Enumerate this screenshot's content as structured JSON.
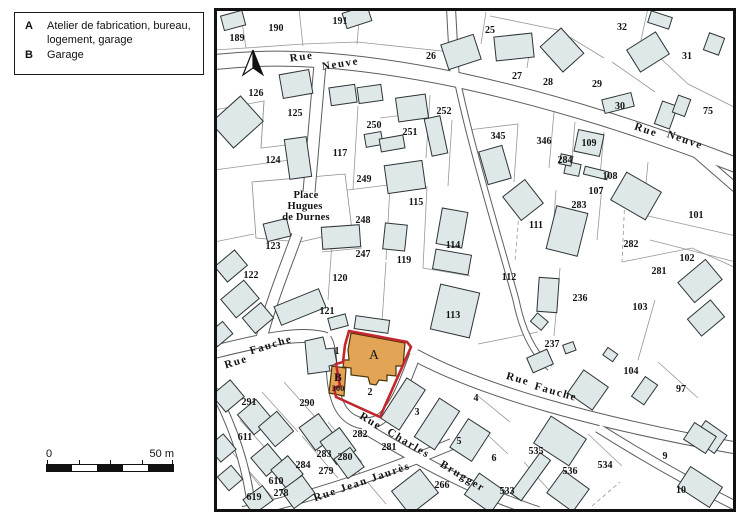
{
  "legend": {
    "items": [
      {
        "key": "A",
        "label": "Atelier de fabrication, bureau,\nlogement, garage"
      },
      {
        "key": "B",
        "label": "Garage"
      }
    ]
  },
  "scale_bar": {
    "start": "0",
    "end": "50 m"
  },
  "map": {
    "colors": {
      "building_fill": "#dfe8e9",
      "highlight_outline": "#c1272d",
      "highlight_building": "#e2a455"
    },
    "highlight": {
      "building_a_label": "A",
      "building_b_label": "B",
      "house_number": "300",
      "parcel_2_label": "2"
    },
    "street_labels": [
      {
        "text": "Rue",
        "x": 302,
        "y": 60,
        "rot": -8,
        "cls": "street"
      },
      {
        "text": "Neuve",
        "x": 341,
        "y": 67,
        "rot": -9,
        "cls": "street"
      },
      {
        "text": "Rue",
        "x": 645,
        "y": 133,
        "rot": 19,
        "cls": "street"
      },
      {
        "text": "Neuve",
        "x": 684,
        "y": 143,
        "rot": 19,
        "cls": "street"
      },
      {
        "text": "Place",
        "x": 306,
        "y": 198,
        "rot": 0,
        "cls": "place"
      },
      {
        "text": "Hugues",
        "x": 305,
        "y": 209,
        "rot": 0,
        "cls": "place"
      },
      {
        "text": "de Durnes",
        "x": 306,
        "y": 220,
        "rot": 0,
        "cls": "place"
      },
      {
        "text": "Rue",
        "x": 237,
        "y": 365,
        "rot": -17,
        "cls": "street"
      },
      {
        "text": "Fauche",
        "x": 272,
        "y": 348,
        "rot": -17,
        "cls": "street"
      },
      {
        "text": "Rue",
        "x": 517,
        "y": 382,
        "rot": 16,
        "cls": "street"
      },
      {
        "text": "Fauche",
        "x": 555,
        "y": 395,
        "rot": 16,
        "cls": "street"
      },
      {
        "text": "Rue",
        "x": 369,
        "y": 424,
        "rot": 31,
        "cls": "street"
      },
      {
        "text": "Charles",
        "x": 407,
        "y": 446,
        "rot": 31,
        "cls": "street"
      },
      {
        "text": "Brugger",
        "x": 461,
        "y": 479,
        "rot": 31,
        "cls": "street"
      },
      {
        "text": "Rue Jean Jaurès",
        "x": 363,
        "y": 485,
        "rot": -19,
        "cls": "street"
      }
    ],
    "parcel_labels": [
      {
        "text": "189",
        "x": 237,
        "y": 41
      },
      {
        "text": "190",
        "x": 276,
        "y": 31
      },
      {
        "text": "191",
        "x": 340,
        "y": 24
      },
      {
        "text": "25",
        "x": 490,
        "y": 33
      },
      {
        "text": "26",
        "x": 431,
        "y": 59
      },
      {
        "text": "27",
        "x": 517,
        "y": 79
      },
      {
        "text": "28",
        "x": 548,
        "y": 85
      },
      {
        "text": "29",
        "x": 597,
        "y": 87
      },
      {
        "text": "30",
        "x": 620,
        "y": 109
      },
      {
        "text": "31",
        "x": 687,
        "y": 59
      },
      {
        "text": "32",
        "x": 622,
        "y": 30
      },
      {
        "text": "75",
        "x": 708,
        "y": 114
      },
      {
        "text": "126",
        "x": 256,
        "y": 96
      },
      {
        "text": "125",
        "x": 295,
        "y": 116
      },
      {
        "text": "124",
        "x": 273,
        "y": 163
      },
      {
        "text": "117",
        "x": 340,
        "y": 156
      },
      {
        "text": "250",
        "x": 374,
        "y": 128
      },
      {
        "text": "251",
        "x": 410,
        "y": 135
      },
      {
        "text": "252",
        "x": 444,
        "y": 114
      },
      {
        "text": "345",
        "x": 498,
        "y": 139
      },
      {
        "text": "346",
        "x": 544,
        "y": 144
      },
      {
        "text": "109",
        "x": 589,
        "y": 146
      },
      {
        "text": "284",
        "x": 565,
        "y": 163
      },
      {
        "text": "108",
        "x": 610,
        "y": 179
      },
      {
        "text": "107",
        "x": 596,
        "y": 194
      },
      {
        "text": "283",
        "x": 579,
        "y": 208
      },
      {
        "text": "101",
        "x": 696,
        "y": 218
      },
      {
        "text": "102",
        "x": 687,
        "y": 261
      },
      {
        "text": "282",
        "x": 631,
        "y": 247
      },
      {
        "text": "281",
        "x": 659,
        "y": 274
      },
      {
        "text": "103",
        "x": 640,
        "y": 310
      },
      {
        "text": "249",
        "x": 364,
        "y": 182
      },
      {
        "text": "115",
        "x": 416,
        "y": 205
      },
      {
        "text": "248",
        "x": 363,
        "y": 223
      },
      {
        "text": "247",
        "x": 363,
        "y": 257
      },
      {
        "text": "123",
        "x": 273,
        "y": 249
      },
      {
        "text": "122",
        "x": 251,
        "y": 278
      },
      {
        "text": "120",
        "x": 340,
        "y": 281
      },
      {
        "text": "121",
        "x": 327,
        "y": 314
      },
      {
        "text": "119",
        "x": 404,
        "y": 263
      },
      {
        "text": "114",
        "x": 453,
        "y": 248
      },
      {
        "text": "113",
        "x": 453,
        "y": 318
      },
      {
        "text": "112",
        "x": 509,
        "y": 280
      },
      {
        "text": "111",
        "x": 536,
        "y": 228
      },
      {
        "text": "236",
        "x": 580,
        "y": 301
      },
      {
        "text": "237",
        "x": 552,
        "y": 347
      },
      {
        "text": "104",
        "x": 631,
        "y": 374
      },
      {
        "text": "97",
        "x": 681,
        "y": 392
      },
      {
        "text": "1",
        "x": 337,
        "y": 354
      },
      {
        "text": "2",
        "x": 370,
        "y": 395
      },
      {
        "text": "3",
        "x": 417,
        "y": 415
      },
      {
        "text": "4",
        "x": 476,
        "y": 401
      },
      {
        "text": "5",
        "x": 459,
        "y": 444
      },
      {
        "text": "6",
        "x": 494,
        "y": 461
      },
      {
        "text": "9",
        "x": 665,
        "y": 459
      },
      {
        "text": "10",
        "x": 681,
        "y": 493
      },
      {
        "text": "291",
        "x": 249,
        "y": 405
      },
      {
        "text": "290",
        "x": 307,
        "y": 406
      },
      {
        "text": "611",
        "x": 245,
        "y": 440
      },
      {
        "text": "282",
        "x": 360,
        "y": 437
      },
      {
        "text": "281",
        "x": 389,
        "y": 450
      },
      {
        "text": "283",
        "x": 324,
        "y": 457
      },
      {
        "text": "280",
        "x": 345,
        "y": 460
      },
      {
        "text": "284",
        "x": 303,
        "y": 468
      },
      {
        "text": "279",
        "x": 326,
        "y": 474
      },
      {
        "text": "610",
        "x": 276,
        "y": 484
      },
      {
        "text": "278",
        "x": 281,
        "y": 496
      },
      {
        "text": "619",
        "x": 254,
        "y": 500
      },
      {
        "text": "266",
        "x": 442,
        "y": 488
      },
      {
        "text": "533",
        "x": 507,
        "y": 494
      },
      {
        "text": "534",
        "x": 605,
        "y": 468
      },
      {
        "text": "535",
        "x": 536,
        "y": 454
      },
      {
        "text": "536",
        "x": 570,
        "y": 474
      }
    ]
  }
}
